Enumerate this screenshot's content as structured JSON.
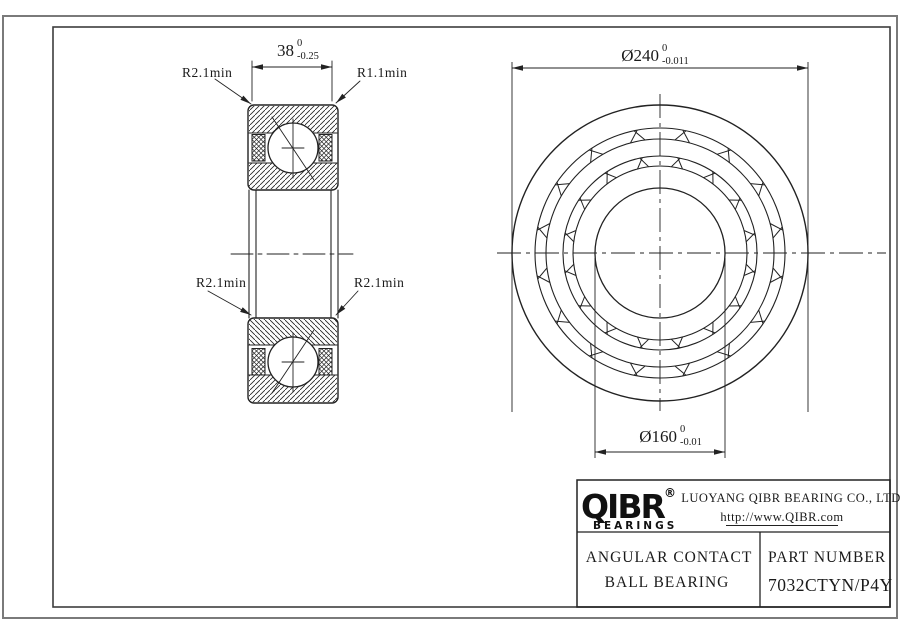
{
  "drawing": {
    "section_view": {
      "dim_width": {
        "nominal": "38",
        "tol_upper": "0",
        "tol_lower": "-0.25"
      },
      "label_top_left": "R2.1min",
      "label_top_right": "R1.1min",
      "label_mid_left": "R2.1min",
      "label_mid_right": "R2.1min"
    },
    "front_view": {
      "dim_outer": {
        "nominal": "Ø240",
        "tol_upper": "0",
        "tol_lower": "-0.011"
      },
      "dim_bore": {
        "nominal": "Ø160",
        "tol_upper": "0",
        "tol_lower": "-0.01"
      }
    },
    "title_block": {
      "logo_text": "QIBR",
      "logo_registered": "®",
      "logo_sub": "BEARINGS",
      "company": "LUOYANG QIBR BEARING CO., LTD",
      "website": "http://www.QIBR.com",
      "product_line1": "ANGULAR CONTACT",
      "product_line2": "BALL BEARING",
      "part_number_label": "PART NUMBER",
      "part_number": "7032CTYN/P4Y"
    },
    "colors": {
      "line": "#222222",
      "frame_outer": "#7a7a7a",
      "frame_inner": "#3d3d3d",
      "background": "#ffffff"
    }
  }
}
